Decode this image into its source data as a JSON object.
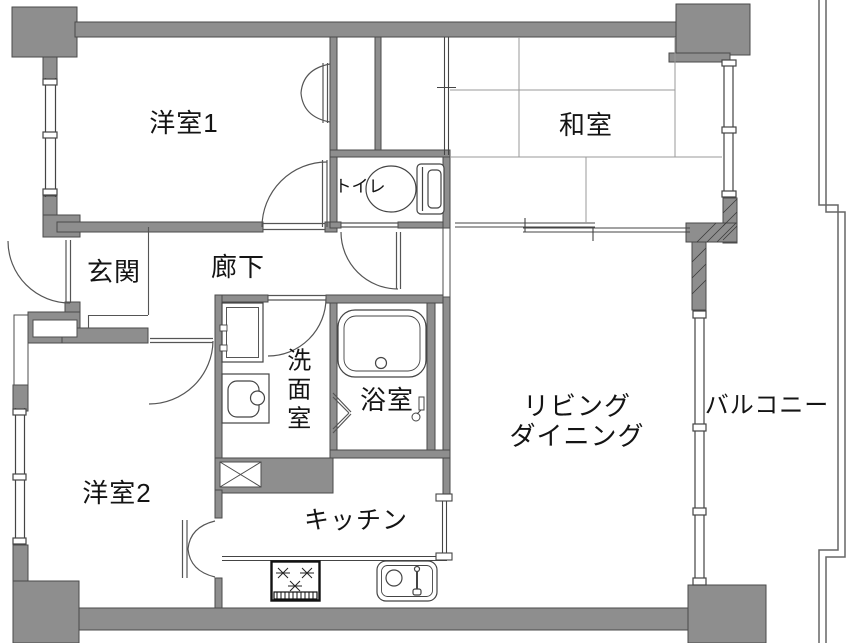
{
  "meta": {
    "type": "apartment-floor-plan"
  },
  "colors": {
    "background": "#ffffff",
    "wall_fill": "#8e8e8e",
    "wall_stroke": "#4a4a4a",
    "thin_line": "#555555",
    "tatami_line": "#9a9a9a",
    "text": "#141414"
  },
  "rooms": [
    {
      "id": "yoshitsu1",
      "label": "洋室1"
    },
    {
      "id": "washitsu",
      "label": "和室"
    },
    {
      "id": "toilet",
      "label": "トイレ"
    },
    {
      "id": "genkan",
      "label": "玄関"
    },
    {
      "id": "rouka",
      "label": "廊下"
    },
    {
      "id": "senmenshitsu",
      "label": "洗面室"
    },
    {
      "id": "yokushitsu",
      "label": "浴室"
    },
    {
      "id": "living",
      "label_line1": "リビング",
      "label_line2": "ダイニング"
    },
    {
      "id": "balcony",
      "label": "バルコニー"
    },
    {
      "id": "yoshitsu2",
      "label": "洋室2"
    },
    {
      "id": "kitchen",
      "label": "キッチン"
    }
  ],
  "icons": [
    "toilet-icon",
    "bathtub-icon",
    "washing-machine-pan-icon",
    "vanity-sink-icon",
    "gas-stove-icon",
    "kitchen-sink-icon",
    "shower-faucet-icon",
    "pipe-space-x-icon",
    "door-swing-arc",
    "bifold-door-arc",
    "sliding-door-mark",
    "window-double-line",
    "balcony-railing"
  ]
}
